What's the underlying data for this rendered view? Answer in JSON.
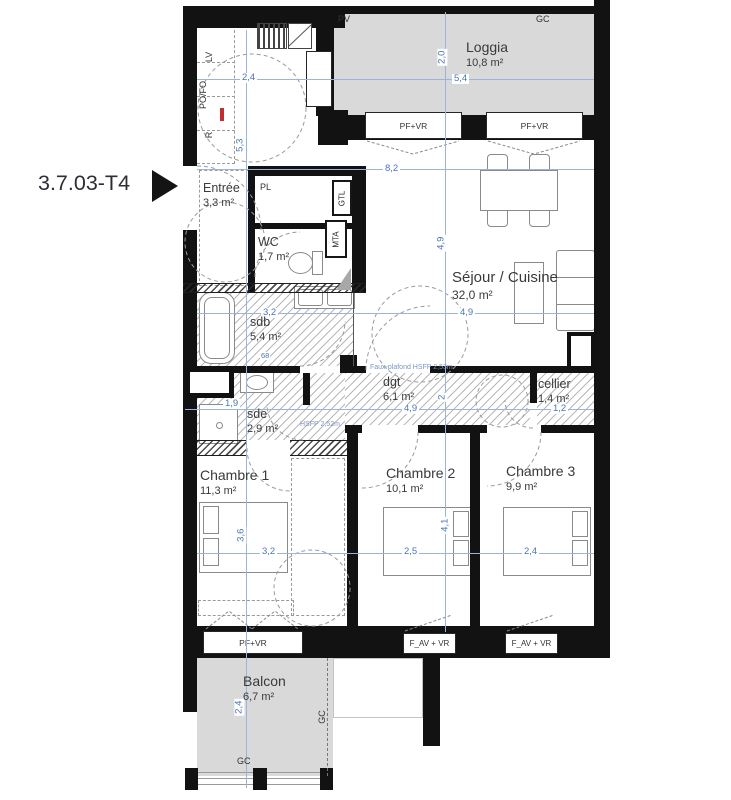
{
  "unit_label": "3.7.03-T4",
  "colors": {
    "wall": "#121212",
    "floor_fill": "#d9d9d9",
    "dimension_blue": "#4a76b8",
    "hatch_gray": "#8a8a8a"
  },
  "rooms": {
    "loggia": {
      "name": "Loggia",
      "area": "10,8 m²"
    },
    "entree": {
      "name": "Entrée",
      "area": "3,3 m²"
    },
    "wc": {
      "name": "WC",
      "area": "1,7 m²"
    },
    "sejour": {
      "name": "Séjour / Cuisine",
      "area": "32,0 m²"
    },
    "sdb": {
      "name": "sdb",
      "area": "5,4 m²"
    },
    "sde": {
      "name": "sde",
      "area": "2,9 m²"
    },
    "dgt": {
      "name": "dgt",
      "area": "6,1 m²"
    },
    "cellier": {
      "name": "cellier",
      "area": "1,4 m²"
    },
    "chambre1": {
      "name": "Chambre 1",
      "area": "11,3 m²"
    },
    "chambre2": {
      "name": "Chambre 2",
      "area": "10,1 m²"
    },
    "chambre3": {
      "name": "Chambre 3",
      "area": "9,9 m²"
    },
    "balcon": {
      "name": "Balcon",
      "area": "6,7 m²"
    }
  },
  "windows": {
    "pf_vr": "PF+VR",
    "f_av_vr": "F_AV + VR"
  },
  "tags": {
    "pv": "PV",
    "gc": "GC",
    "pl": "PL",
    "gtl": "GTL",
    "mta": "MTA",
    "lv": "LV",
    "pofo": "PO/FO",
    "r": "R"
  },
  "annotations": {
    "dgt_ceiling": "Faux-plafond HSFP 2,53m",
    "sde_ceiling": "HSFP 2,52m",
    "vanity_width": "68"
  },
  "dims": {
    "kitchen_width": "2,4",
    "entry_height": "5,3",
    "loggia_depth": "2,0",
    "loggia_width": "5,4",
    "sejour_width": "8,2",
    "sejour_depth": "4,9",
    "sejour_width2": "4,9",
    "sdb_width": "3,2",
    "hall_width": "1,9",
    "dgt_length": "4,9",
    "dgt_depth": "2",
    "cellier_width": "1,2",
    "ch1_depth": "3,6",
    "ch1_width": "3,2",
    "ch2_width": "2,5",
    "ch2_depth": "4,1",
    "ch3_width": "2,4",
    "balcon_depth": "2,4"
  }
}
